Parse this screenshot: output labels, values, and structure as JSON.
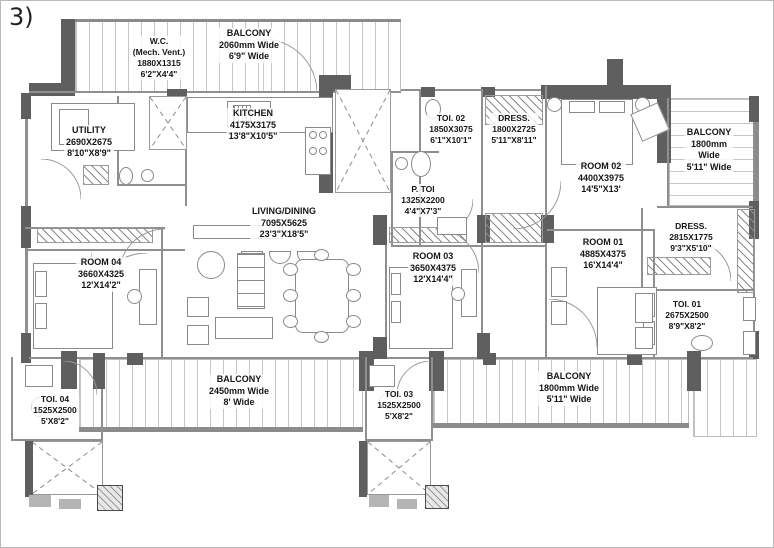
{
  "figure_label": "3)",
  "colors": {
    "wall": "#5f5f5f",
    "partition": "#8f8f8f",
    "stripe": "#c6c6c6",
    "text": "#161616"
  },
  "rooms": {
    "wc": {
      "name": "W.C.",
      "note": "(Mech. Vent.)",
      "mm": "1880X1315",
      "ft": "6'2\"X4'4\""
    },
    "balcony_top": {
      "name": "BALCONY",
      "l2": "2060mm Wide",
      "l3": "6'9\" Wide"
    },
    "utility": {
      "name": "UTILITY",
      "mm": "2690X2675",
      "ft": "8'10\"X8'9\""
    },
    "kitchen": {
      "name": "KITCHEN",
      "mm": "4175X3175",
      "ft": "13'8\"X10'5\""
    },
    "toi02": {
      "name": "TOI. 02",
      "mm": "1850X3075",
      "ft": "6'1\"X10'1\""
    },
    "dress02": {
      "name": "DRESS.",
      "mm": "1800X2725",
      "ft": "5'11\"X8'11\""
    },
    "ptoi": {
      "name": "P. TOI",
      "mm": "1325X2200",
      "ft": "4'4\"X7'3\""
    },
    "room02": {
      "name": "ROOM 02",
      "mm": "4400X3975",
      "ft": "14'5\"X13'"
    },
    "balcony_right": {
      "name": "BALCONY",
      "l2": "1800mm",
      "l3": "Wide",
      "l4": "5'11\" Wide"
    },
    "living": {
      "name": "LIVING/DINING",
      "mm": "7095X5625",
      "ft": "23'3\"X18'5\""
    },
    "room04": {
      "name": "ROOM 04",
      "mm": "3660X4325",
      "ft": "12'X14'2\""
    },
    "room03": {
      "name": "ROOM 03",
      "mm": "3650X4375",
      "ft": "12'X14'4\""
    },
    "room01": {
      "name": "ROOM 01",
      "mm": "4885X4375",
      "ft": "16'X14'4\""
    },
    "dress01": {
      "name": "DRESS.",
      "mm": "2815X1775",
      "ft": "9'3\"X5'10\""
    },
    "toi01": {
      "name": "TOI. 01",
      "mm": "2675X2500",
      "ft": "8'9\"X8'2\""
    },
    "toi04": {
      "name": "TOI. 04",
      "mm": "1525X2500",
      "ft": "5'X8'2\""
    },
    "balcony_bottom_left": {
      "name": "BALCONY",
      "l2": "2450mm Wide",
      "l3": "8' Wide"
    },
    "toi03": {
      "name": "TOI. 03",
      "mm": "1525X2500",
      "ft": "5'X8'2\""
    },
    "balcony_bottom_right": {
      "name": "BALCONY",
      "l2": "1800mm Wide",
      "l3": "5'11\" Wide"
    }
  }
}
